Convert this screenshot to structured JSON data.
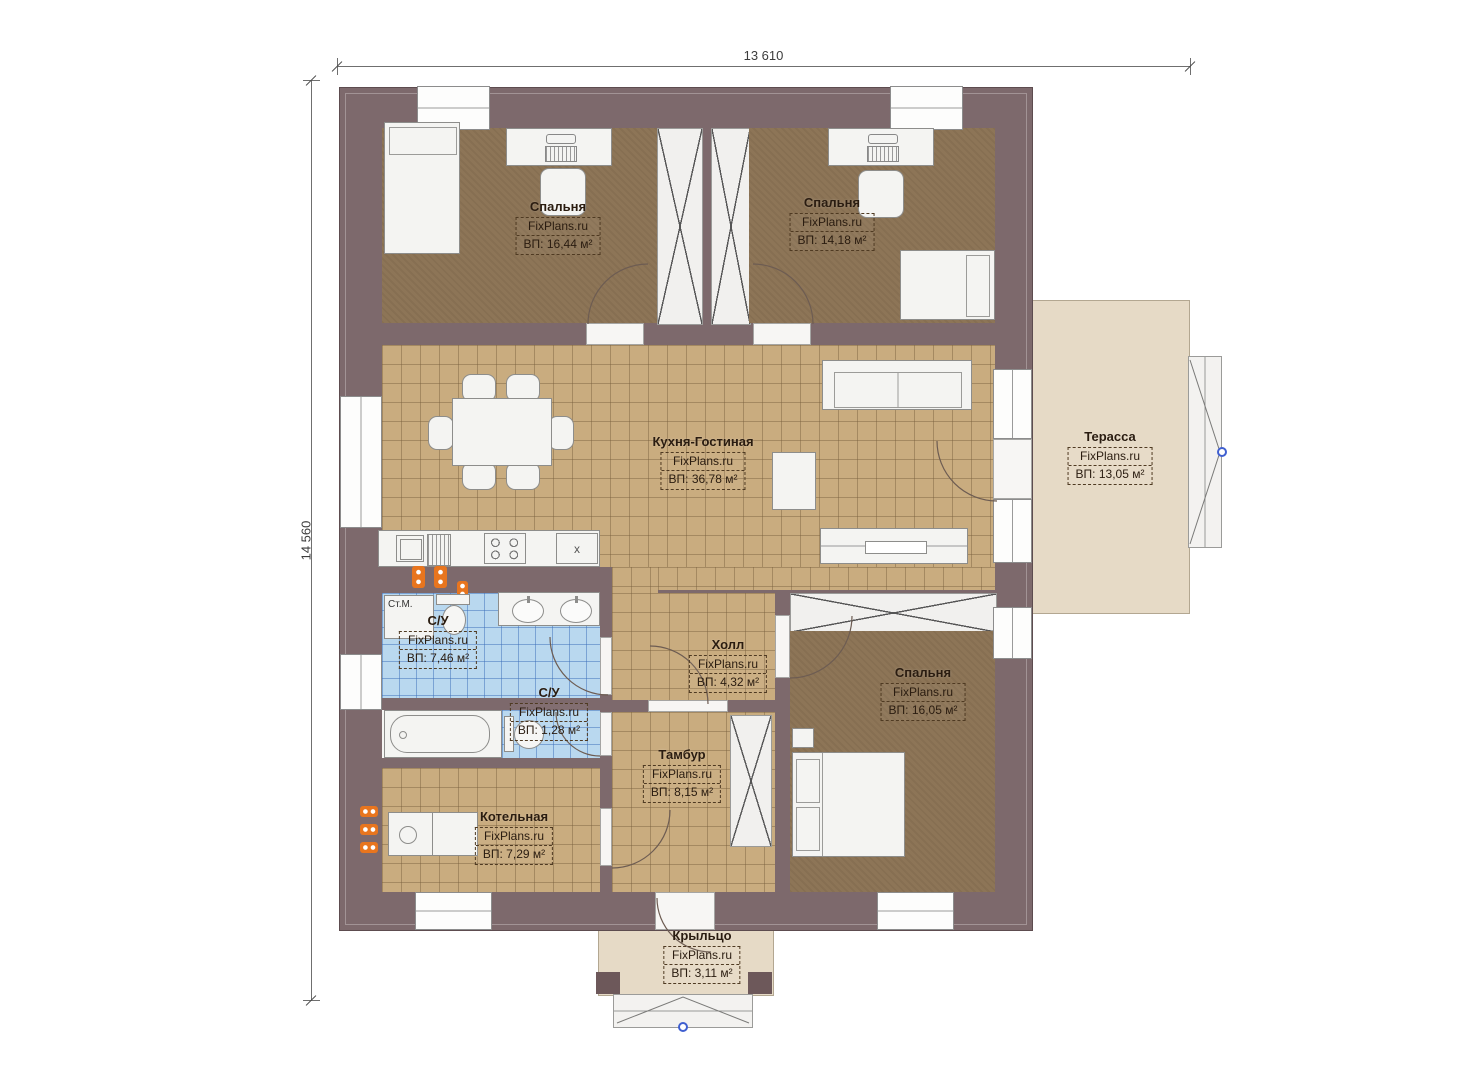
{
  "dimensions": {
    "top": "13 610",
    "left": "14 560"
  },
  "rooms": [
    {
      "id": "bedroom1",
      "name": "Спальня",
      "brand": "FixPlans.ru",
      "area": "ВП: 16,44 м²"
    },
    {
      "id": "bedroom2",
      "name": "Спальня",
      "brand": "FixPlans.ru",
      "area": "ВП: 14,18 м²"
    },
    {
      "id": "kitchen",
      "name": "Кухня-Гостиная",
      "brand": "FixPlans.ru",
      "area": "ВП: 36,78 м²"
    },
    {
      "id": "terrace",
      "name": "Терасса",
      "brand": "FixPlans.ru",
      "area": "ВП: 13,05 м²"
    },
    {
      "id": "bathroom",
      "name": "С/У",
      "brand": "FixPlans.ru",
      "area": "ВП: 7,46 м²"
    },
    {
      "id": "wc",
      "name": "С/У",
      "brand": "FixPlans.ru",
      "area": "ВП: 1,28 м²"
    },
    {
      "id": "hall",
      "name": "Холл",
      "brand": "FixPlans.ru",
      "area": "ВП: 4,32 м²"
    },
    {
      "id": "bedroom3",
      "name": "Спальня",
      "brand": "FixPlans.ru",
      "area": "ВП: 16,05 м²"
    },
    {
      "id": "tambour",
      "name": "Тамбур",
      "brand": "FixPlans.ru",
      "area": "ВП: 8,15 м²"
    },
    {
      "id": "boiler",
      "name": "Котельная",
      "brand": "FixPlans.ru",
      "area": "ВП: 7,29 м²"
    },
    {
      "id": "porch",
      "name": "Крыльцо",
      "brand": "FixPlans.ru",
      "area": "ВП: 3,11 м²"
    }
  ],
  "labels": {
    "washing_machine": "Ст.М.",
    "cabinet_marker": "x"
  },
  "colors": {
    "wall": "#7d696c",
    "bedroom_floor": "#8d7557",
    "tile_floor": "#c9ac7f",
    "bath_floor": "#b9d8ef",
    "terrace_floor": "#e6dac6",
    "furniture": "#f4f4f2",
    "radiator": "#e8751e",
    "stair_marker": "#3f5fd0",
    "label_text": "#2a1c10"
  }
}
